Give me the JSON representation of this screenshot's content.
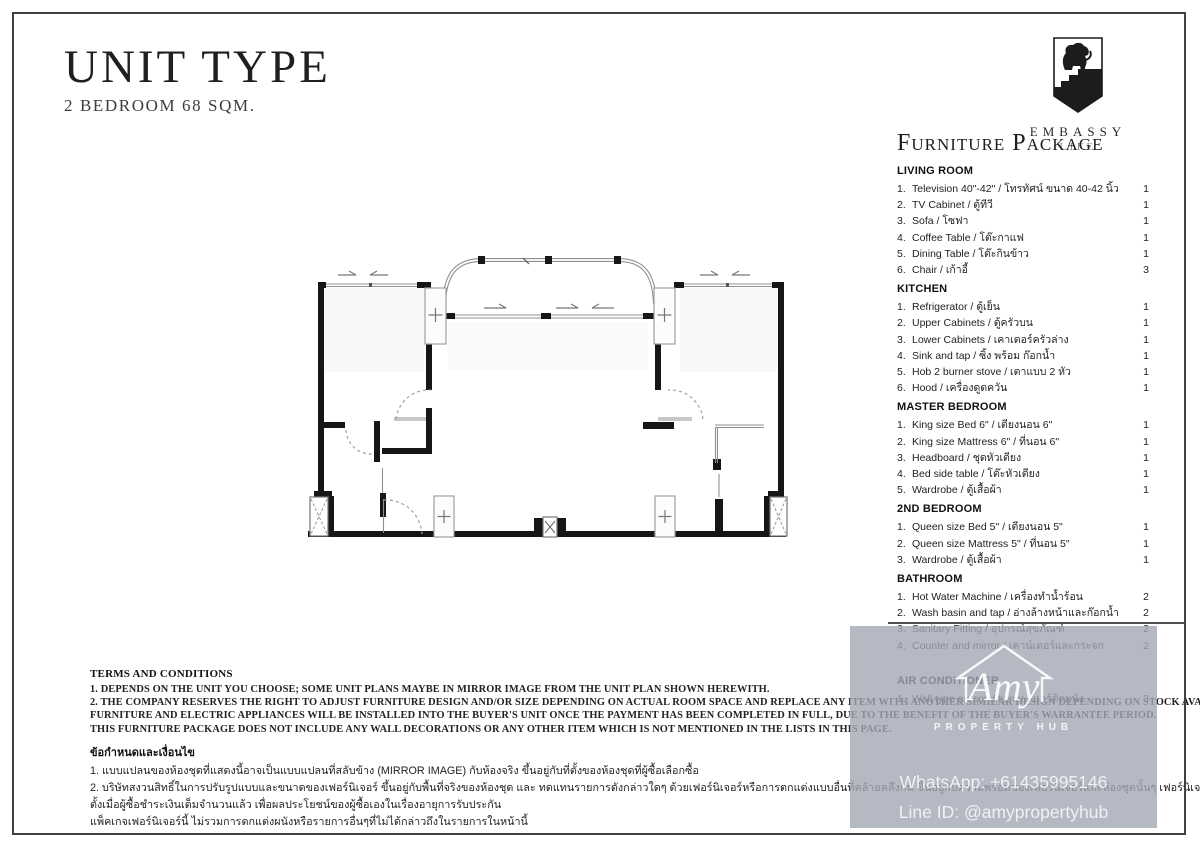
{
  "header": {
    "title": "UNIT TYPE",
    "subtitle": "2 BEDROOM 68 SQM."
  },
  "brand": {
    "name": "EMBASSY",
    "sub": "LIFE",
    "logo_icon": "lion-shield-icon"
  },
  "furniture": {
    "heading": "Furniture Package",
    "sections": [
      {
        "name": "LIVING ROOM",
        "items": [
          {
            "label": "Television 40\"-42\" / โทรทัศน์ ขนาด 40-42 นิ้ว",
            "qty": "1"
          },
          {
            "label": "TV Cabinet / ตู้ทีวี",
            "qty": "1"
          },
          {
            "label": "Sofa / โซฟา",
            "qty": "1"
          },
          {
            "label": "Coffee Table / โต๊ะกาแฟ",
            "qty": "1"
          },
          {
            "label": "Dining Table / โต๊ะกินข้าว",
            "qty": "1"
          },
          {
            "label": "Chair / เก้าอี้",
            "qty": "3"
          }
        ]
      },
      {
        "name": "KITCHEN",
        "items": [
          {
            "label": "Refrigerator / ตู้เย็น",
            "qty": "1"
          },
          {
            "label": "Upper Cabinets / ตู้ครัวบน",
            "qty": "1"
          },
          {
            "label": "Lower Cabinets / เคาเตอร์ครัวล่าง",
            "qty": "1"
          },
          {
            "label": "Sink and tap / ซิ้ง พร้อม ก๊อกน้ำ",
            "qty": "1"
          },
          {
            "label": "Hob 2 burner stove / เตาแบบ 2 หัว",
            "qty": "1"
          },
          {
            "label": "Hood / เครื่องดูดควัน",
            "qty": "1"
          }
        ]
      },
      {
        "name": "MASTER BEDROOM",
        "items": [
          {
            "label": "King size Bed 6\" / เตียงนอน 6\"",
            "qty": "1"
          },
          {
            "label": "King size Mattress 6\" / ที่นอน 6\"",
            "qty": "1"
          },
          {
            "label": "Headboard / ชุดหัวเตียง",
            "qty": "1"
          },
          {
            "label": "Bed side table / โต๊ะหัวเตียง",
            "qty": "1"
          },
          {
            "label": "Wardrobe / ตู้เสื้อผ้า",
            "qty": "1"
          }
        ]
      },
      {
        "name": "2ND BEDROOM",
        "items": [
          {
            "label": "Queen size Bed 5\" / เตียงนอน 5\"",
            "qty": "1"
          },
          {
            "label": "Queen size Mattress 5\" / ที่นอน 5\"",
            "qty": "1"
          },
          {
            "label": "Wardrobe / ตู้เสื้อผ้า",
            "qty": "1"
          }
        ]
      },
      {
        "name": "BATHROOM",
        "items": [
          {
            "label": "Hot Water Machine / เครื่องทำน้ำร้อน",
            "qty": "2"
          },
          {
            "label": "Wash basin and tap / อ่างล้างหน้าและก๊อกน้ำ",
            "qty": "2"
          },
          {
            "label": "Sanitary Fitting / อุปกรณ์สุขภัณฑ์",
            "qty": "2"
          },
          {
            "label": "Counter and mirror / เคาน์เตอร์และกระจก",
            "qty": "2"
          }
        ]
      },
      {
        "name": "AIR CONDITIONER",
        "items": [
          {
            "label": "Wall type air-conditioner / แอร์ติดผนัง",
            "qty": "3"
          }
        ]
      }
    ]
  },
  "terms": {
    "en_heading": "TERMS AND CONDITIONS",
    "en_lines": [
      "1. DEPENDS ON THE UNIT YOU CHOOSE; SOME UNIT PLANS MAYBE IN MIRROR IMAGE FROM THE UNIT PLAN SHOWN HEREWITH.",
      "2. THE COMPANY RESERVES THE RIGHT TO ADJUST FURNITURE DESIGN AND/OR SIZE DEPENDING ON ACTUAL ROOM SPACE AND REPLACE ANY ITEM WITH ANOTHER SIMILAR DESIGN DEPENDING ON STOCK AVAILABILITY. ALL LOOSE",
      "FURNITURE AND ELECTRIC APPLIANCES WILL BE INSTALLED INTO THE BUYER'S UNIT ONCE THE PAYMENT HAS BEEN COMPLETED IN FULL, DUE TO THE BENEFIT OF THE BUYER'S WARRANTEE PERIOD.",
      "THIS FURNITURE PACKAGE DOES NOT INCLUDE ANY WALL DECORATIONS OR ANY OTHER ITEM WHICH IS NOT MENTIONED IN THE LISTS IN THIS PAGE."
    ],
    "th_heading": "ข้อกำหนดและเงื่อนไข",
    "th_lines": [
      "1. แบบแปลนของห้องชุดที่แสดงนี้อาจเป็นแบบแปลนที่สลับข้าง (MIRROR IMAGE) กับห้องจริง ขึ้นอยู่กับที่ตั้งของห้องชุดที่ผู้ซื้อเลือกซื้อ",
      "2. บริษัทสงวนสิทธิ์ในการปรับรูปแบบและขนาดของเฟอร์นิเจอร์ ขึ้นอยู่กับพื้นที่จริงของห้องชุด และ ทดแทนรายการดังกล่าวใดๆ ด้วยเฟอร์นิเจอร์หรือการตกแต่งแบบอื่นที่คล้ายคลึงกัน ขึ้นอยู่กับความพร้อมของเฟอร์นิเจอร์และห้องชุดนั้นๆ เฟอร์นิเจอร์ลอยตัวและเครื่องใช้ไฟฟ้าทั้งหมดจะถูกติด",
      "ตั้งเมื่อผู้ซื้อชำระเงินเต็มจำนวนแล้ว เพื่อผลประโยชน์ของผู้ซื้อเองในเรื่องอายุการรับประกัน",
      "แพ็คเกจเฟอร์นิเจอร์นี้ ไม่รวมการตกแต่งผนังหรือรายการอื่นๆที่ไม่ได้กล่าวถึงในรายการในหน้านี้"
    ]
  },
  "watermark": {
    "logo_icon": "house-outline-icon",
    "logo_script": "Amy",
    "logo_sub": "PROPERTY HUB",
    "whatsapp": "WhatsApp: +61435995146",
    "line_id": "Line ID: @amypropertyhub",
    "bg_color": "#b5b9c3"
  }
}
